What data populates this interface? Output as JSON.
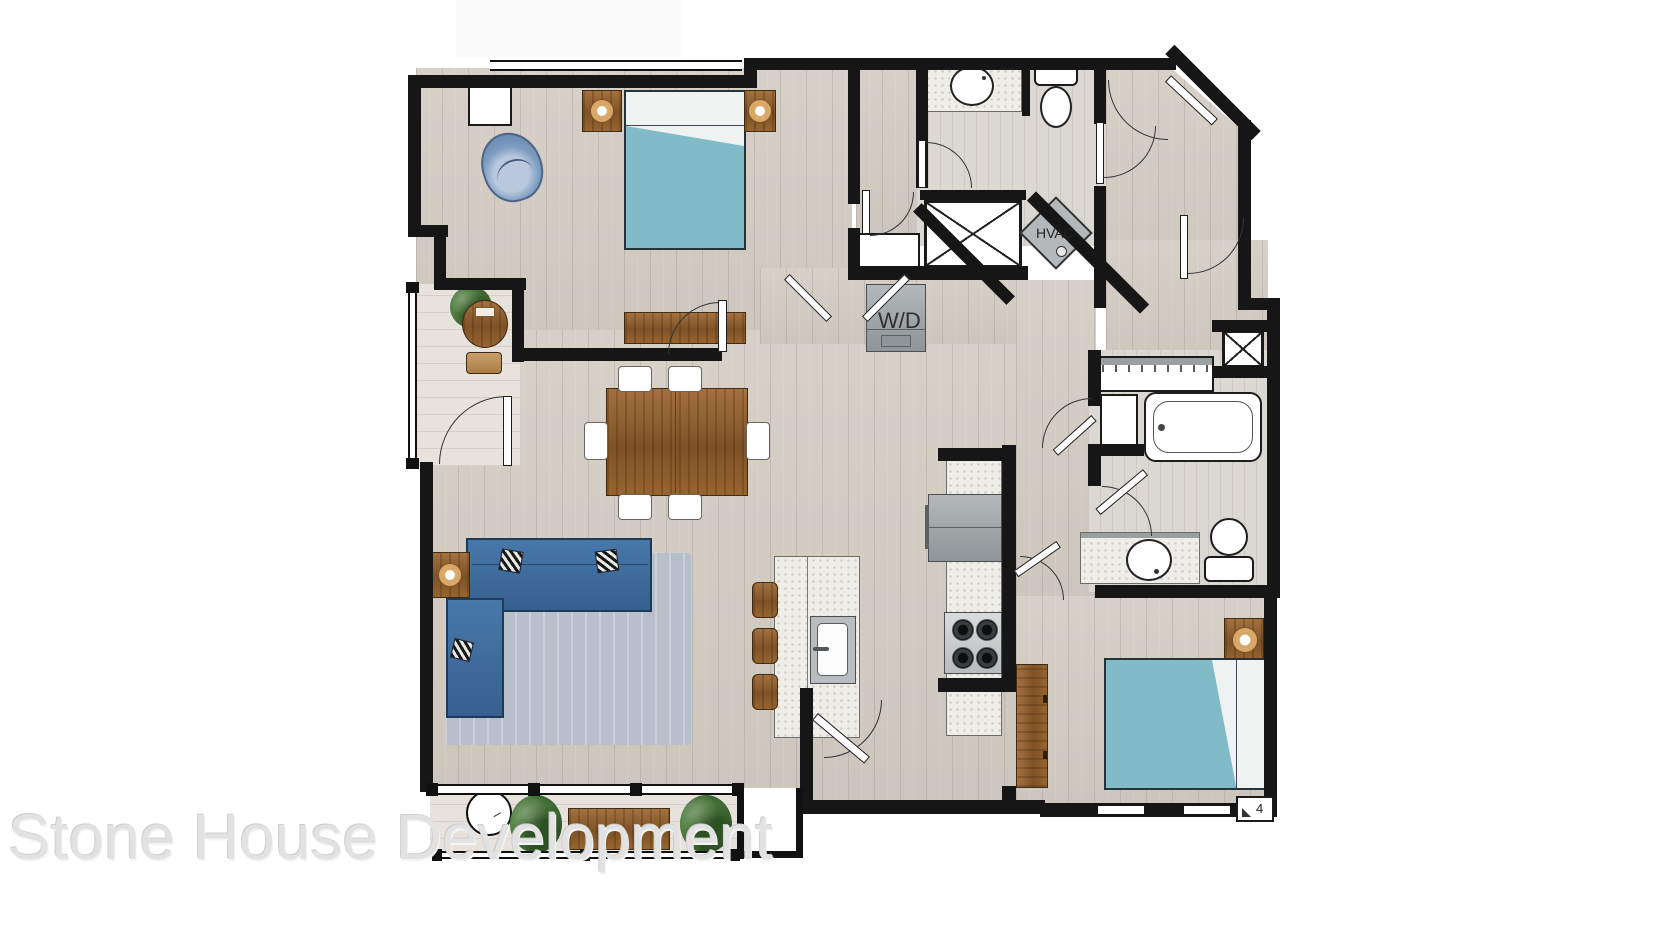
{
  "floor_plan": {
    "appliance_labels": {
      "washer_dryer": "W/D",
      "hvac": "HVAC"
    },
    "corner_marker": "4",
    "watermark": "Stone House Development",
    "palette": {
      "wall": "#161616",
      "floor_wood": "#d5cec5",
      "floor_tile": "#dbd7d2",
      "balcony_floor": "#e7e2db",
      "bed_blue": "#82bbc8",
      "sofa_blue": "#3d6a9c",
      "rug_blue_gray": "#b7c0ca",
      "wood_brown": "#8a5a2f",
      "counter_speckle": "#efede8",
      "appliance_gray": "#a3a8ab",
      "plant_green": "#4a7a3a",
      "watermark_gray": "#e2e2e2"
    }
  }
}
